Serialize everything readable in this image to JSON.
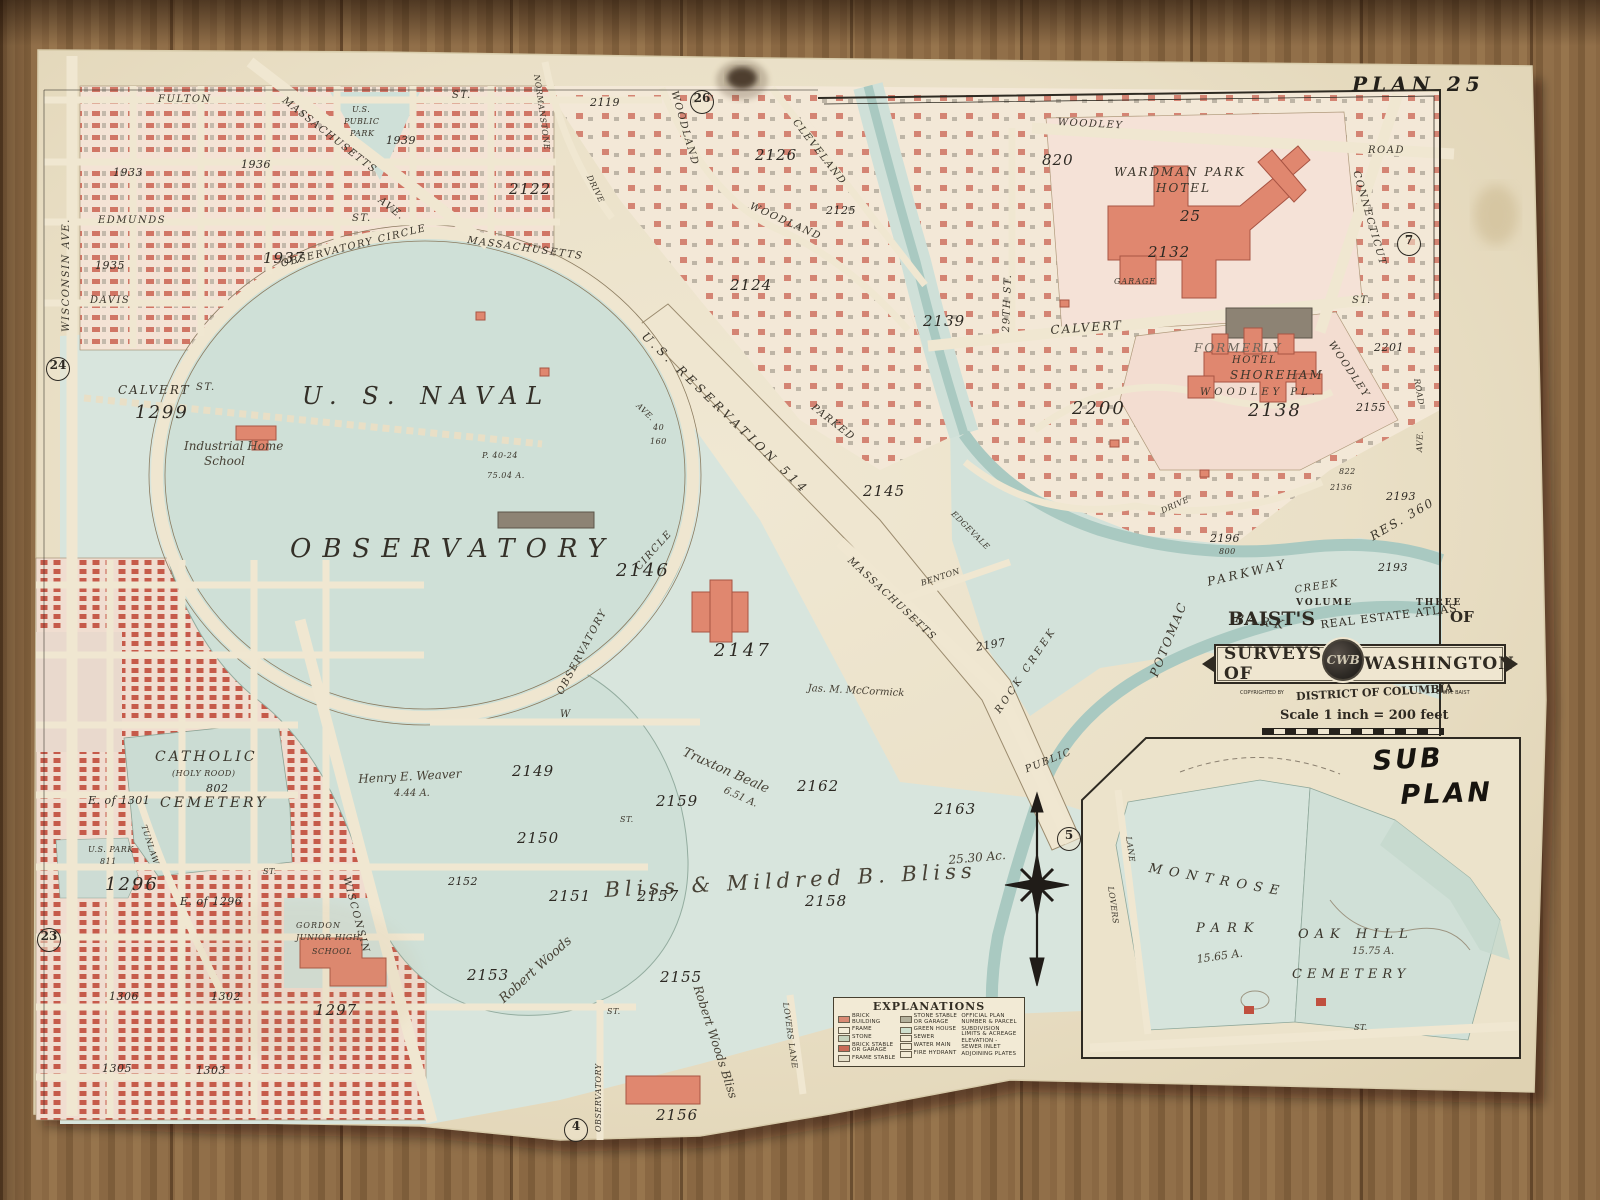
{
  "plate": {
    "label": "PLAN 25"
  },
  "plate_refs": {
    "top": "26",
    "right": "7",
    "west": "24",
    "southwest": "23",
    "south": "4",
    "center": "5"
  },
  "colors": {
    "paper": "#eae0c8",
    "park_green": "#d3e2d9",
    "block_pink": "#f5e3d6",
    "brick_red": "#c14b3c",
    "hotel_salmon": "#e0876f",
    "creek_blue": "#a9c9c1",
    "wood": "#8a6843"
  },
  "streets": {
    "fulton": "FULTON",
    "fulton_st": "ST.",
    "massachusetts_nw": "MASSACHUSETTS",
    "massachusetts_nw_ave": "AVE.",
    "us_public": "U.S.",
    "public": "PUBLIC",
    "park": "PARK",
    "edmunds": "EDMUNDS",
    "edmunds_st": "ST.",
    "davis": "DAVIS",
    "wisconsin_ave": "WISCONSIN AVE.",
    "observatory_circle": "OBSERVATORY CIRCLE",
    "massachusetts_circle": "MASSACHUSETTS",
    "us_reservation": "U.S. RESERVATION 514",
    "reservation_ave": "AVE.",
    "forty": "40",
    "one_sixty": "160",
    "parked": "PARKED",
    "massachusetts_se": "MASSACHUSETTS",
    "observatory_sw": "OBSERVATORY",
    "circle_sw": "CIRCLE",
    "calvert_w": "CALVERT",
    "calvert_w_st": "ST.",
    "calvert_e": "CALVERT",
    "calvert_e_st": "ST.",
    "woodley_rd": "WOODLEY",
    "woodley_rd_road": "ROAD",
    "connecticut": "CONNECTICUT",
    "twentyninth": "29TH ST.",
    "cleveland": "CLEVELAND",
    "woodland_n": "WOODLAND",
    "woodland_s": "WOODLAND",
    "normanstone": "NORMANSTONE",
    "normanstone_drive": "DRIVE",
    "woodley_e": "WOODLEY",
    "road_e": "ROAD",
    "ave_e": "AVE.",
    "potomac": "POTOMAC",
    "parkway": "PARKWAY",
    "park_band": "PARK",
    "creek": "CREEK",
    "rock_creek": "ROCK CREEK",
    "public_creek": "PUBLIC",
    "edgevale": "EDGEVALE",
    "benton": "BENTON",
    "drive_e": "DRIVE",
    "tunlaw": "TUNLAW",
    "wisconsin_diag": "WISCONSIN",
    "lovers_lane": "LOVERS LANE",
    "w_street": "W",
    "observatory_st": "OBSERVATORY",
    "st1": "ST.",
    "st2": "ST.",
    "st3": "ST."
  },
  "squares": {
    "s1933": "1933",
    "s1935": "1935",
    "s1936": "1936",
    "s1937": "1937",
    "s1939": "1939",
    "s1296": "1296",
    "e1296": "E. of 1296",
    "e1301": "E. of 1301",
    "s1297": "1297",
    "s1299": "1299",
    "s1302": "1302",
    "s1303": "1303",
    "s1305": "1305",
    "s1306": "1306",
    "s2119": "2119",
    "s2122": "2122",
    "s2124": "2124",
    "s2125": "2125",
    "s2126": "2126",
    "s2132": "2132",
    "s2136": "2136",
    "s2138": "2138",
    "s2139": "2139",
    "s2145": "2145",
    "s2146": "2146",
    "s2147": "2147",
    "s2149": "2149",
    "s2150": "2150",
    "s2151": "2151",
    "s2152": "2152",
    "s2153": "2153",
    "s2155": "2155",
    "s2155e": "2155",
    "s2156": "2156",
    "s2157": "2157",
    "s2158": "2158",
    "s2159": "2159",
    "s2162": "2162",
    "s2163": "2163",
    "s2193a": "2193",
    "s2193b": "2193",
    "s2196": "2196",
    "s2196p": "800",
    "s2197": "2197",
    "s2200": "2200",
    "s2201": "2201",
    "s820": "820",
    "s822": "822",
    "s25": "25",
    "res360": "RES. 360",
    "s802": "802",
    "s811": "811"
  },
  "places": {
    "naval": "U. S. NAVAL",
    "observatory": "OBSERVATORY",
    "obs_parcel": "P. 40-24",
    "obs_acreage": "75.04 A.",
    "catholic": "CATHOLIC",
    "holy_rood": "(HOLY ROOD)",
    "cemetery": "CEMETERY",
    "industrial1": "Industrial Home",
    "industrial2": "School",
    "us_park": "U.S. PARK",
    "wardman1": "WARDMAN PARK",
    "wardman2": "HOTEL",
    "garage": "GARAGE",
    "formerly": "FORMERLY",
    "hotel": "HOTEL",
    "shoreham": "SHOREHAM",
    "woodley_pl": "WOODLEY PL.",
    "gordon1": "GORDON",
    "gordon2": "JUNIOR HIGH",
    "gordon3": "SCHOOL"
  },
  "handwriting": {
    "bliss": "Bliss & Mildred B. Bliss",
    "bliss_acreage": "25.30 Ac.",
    "robert_woods": "Robert Woods",
    "robert_woods_bliss": "Robert Woods Bliss",
    "truxton": "Truxton Beale",
    "truxton_acreage": "6.51 A.",
    "weaver": "Henry E. Weaver",
    "weaver_acreage": "4.44 A.",
    "mccormick": "Jas. M. McCormick",
    "sub": "SUB",
    "plan": "PLAN"
  },
  "sub_plan": {
    "montrose": "MONTROSE",
    "park": "PARK",
    "montrose_acreage": "15.65 A.",
    "oak_hill": "OAK HILL",
    "cemetery": "CEMETERY",
    "oak_acreage": "15.75 A.",
    "lovers": "LOVERS",
    "lane": "LANE",
    "street": "ST."
  },
  "title_block": {
    "volume": "VOLUME",
    "three": "THREE",
    "baists": "BAIST'S",
    "atlas": "REAL ESTATE ATLAS",
    "of": "OF",
    "surveys": "SURVEYS OF",
    "washington": "WASHINGTON",
    "monogram": "CWB",
    "copyrighted": "COPYRIGHTED BY",
    "district": "DISTRICT OF COLUMBIA",
    "author": "C. WM. BAIST",
    "scale": "Scale 1 inch = 200 feet"
  },
  "legend": {
    "title": "EXPLANATIONS",
    "col1": [
      {
        "label": "BRICK BUILDING",
        "color": "#d98a74"
      },
      {
        "label": "FRAME",
        "color": "#f3ecd8"
      },
      {
        "label": "STONE",
        "color": "#c5d2bd"
      },
      {
        "label": "BRICK STABLE OR GARAGE",
        "color": "#c96b58"
      },
      {
        "label": "FRAME STABLE",
        "color": "#e6e0ca"
      }
    ],
    "col2": [
      {
        "label": "STONE STABLE OR GARAGE",
        "color": "#b3b09c"
      },
      {
        "label": "GREEN HOUSE",
        "color": "#cfe0cf"
      },
      {
        "label": "SEWER",
        "color": ""
      },
      {
        "label": "WATER MAIN",
        "color": ""
      },
      {
        "label": "FIRE HYDRANT",
        "color": ""
      }
    ],
    "col3": [
      {
        "label": "OFFICIAL PLAN NUMBER & PARCEL"
      },
      {
        "label": "SUBDIVISION LIMITS & ACREAGE"
      },
      {
        "label": "ELEVATION - SEWER INLET"
      },
      {
        "label": "ADJOINING PLATES"
      }
    ]
  }
}
